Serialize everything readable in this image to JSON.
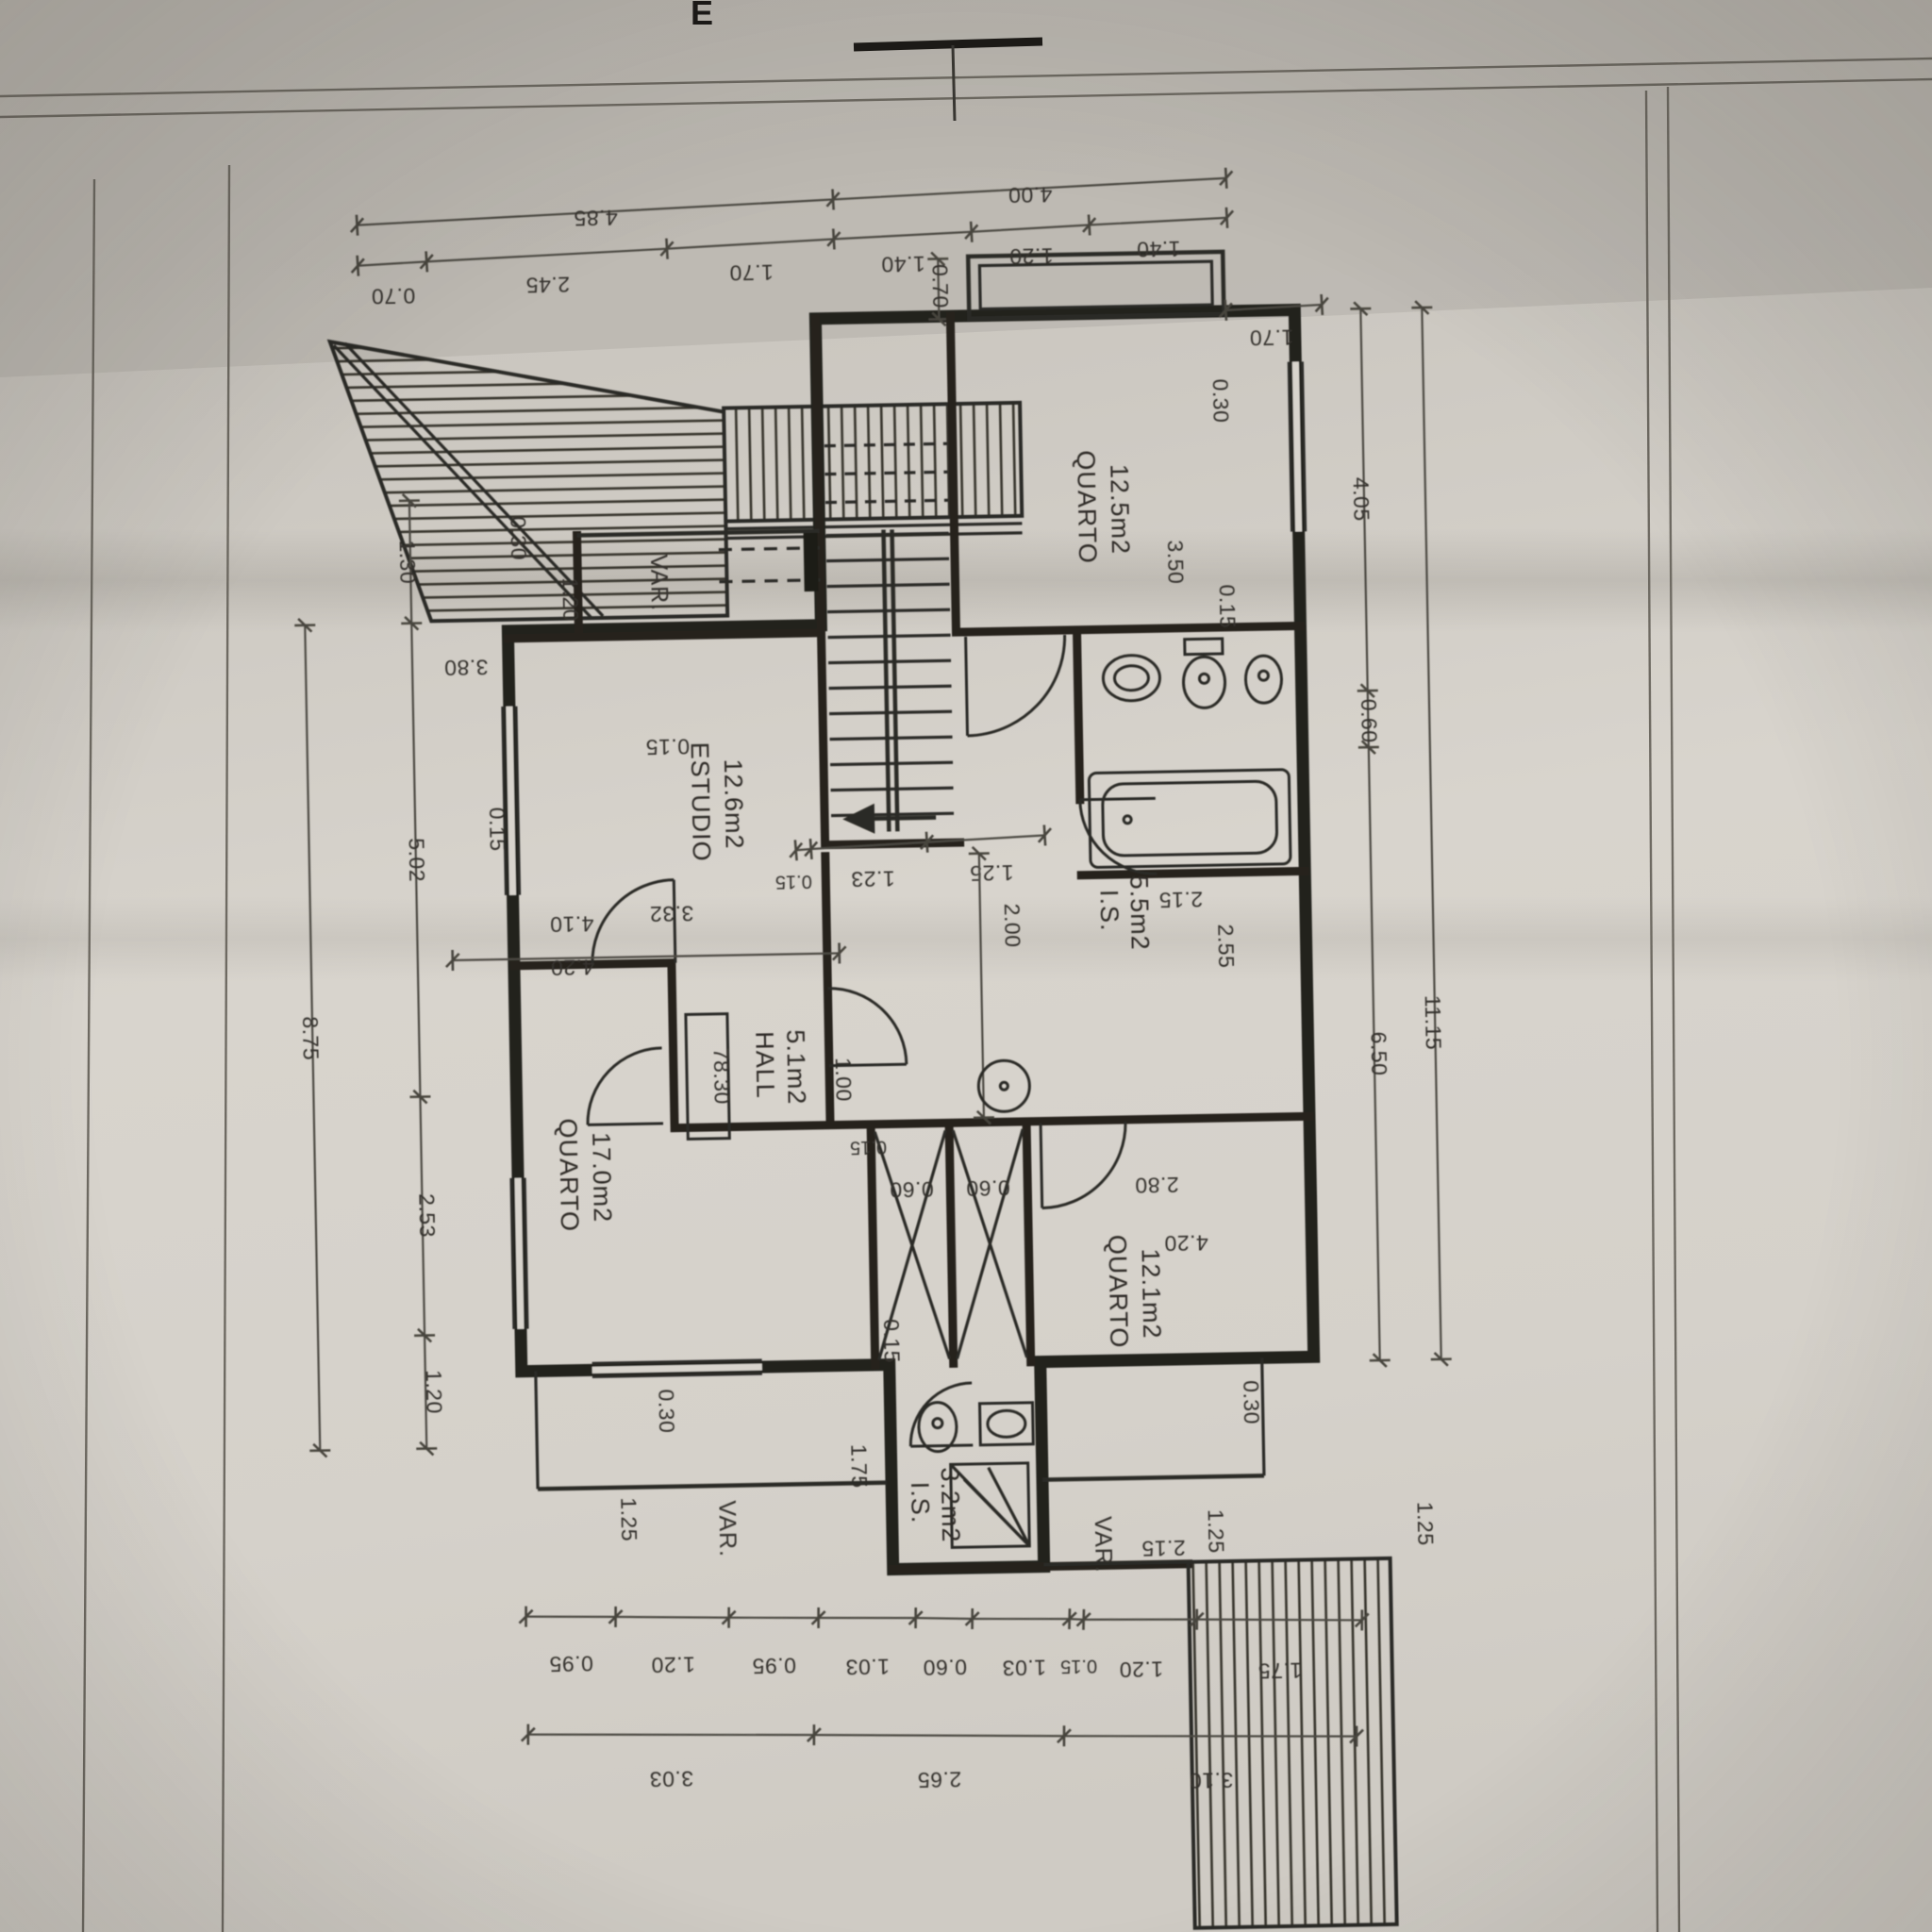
{
  "sheet": {
    "edge_letter": "E"
  },
  "rooms": {
    "q125": {
      "name": "QUARTO",
      "area": "12.5m2"
    },
    "estudio": {
      "name": "ESTUDIO",
      "area": "12.6m2"
    },
    "hall": {
      "name": "HALL",
      "area": "5.1m2"
    },
    "is55": {
      "name": "I.S.",
      "area": "5.5m2"
    },
    "q170": {
      "name": "QUARTO",
      "area": "17.0m2"
    },
    "q121": {
      "name": "QUARTO",
      "area": "12.1m2"
    },
    "is32": {
      "name": "I.S.",
      "area": "3.2m2"
    }
  },
  "labels": {
    "var": "VAR.",
    "level": "78.30"
  },
  "chains": {
    "top_outer": [
      "4.85",
      "4.00"
    ],
    "top_inner": [
      "0.70",
      "2.45",
      "1.70",
      "1.40",
      "1.20",
      "1.40"
    ],
    "top_right_extra": "1.70",
    "left_inner": [
      "1.30",
      "5.02",
      "2.53",
      "1.20"
    ],
    "left_outer": "8.75",
    "right_inner": [
      "4.05",
      "0.60",
      "6.50"
    ],
    "right_total": "11.15",
    "bottom_inner": [
      "0.95",
      "1.20",
      "0.95",
      "1.03",
      "0.60",
      "1.03",
      "0.15",
      "1.20",
      "1.75"
    ],
    "bottom_outer": [
      "3.03",
      "2.65",
      "3.10"
    ]
  },
  "dims": {
    "balcony_depth": "0.70",
    "var_top_width": "1.20",
    "var_top_wall": "0.30",
    "estudio_height": "3.80",
    "stair_wall": "0.15",
    "estudio_width": "3.32",
    "left_wall": "0.15",
    "stair_chain_a": "0.15",
    "stair_chain_b": "1.23",
    "stair_chain_c": "1.25",
    "corridor_length": "2.00",
    "hall_door": "1.00",
    "q125_side_wall": "0.30",
    "q125_depth": "3.50",
    "q125_bath_wall": "0.15",
    "bath_width": "2.15",
    "bath_length": "2.55",
    "corr_wall": "0.15",
    "ward_a": "0.60",
    "ward_b": "0.60",
    "ward_side": "0.15",
    "q170_inner": "4.10",
    "q170_outer": "4.20",
    "q121_inner": "2.80",
    "q121_outer": "4.20",
    "porch_left_wall": "0.30",
    "porch_right_wall": "0.30",
    "ext_depth": "1.75",
    "porch_left_depth": "1.25",
    "porch_right_width": "2.15",
    "porch_right_depth": "1.25",
    "terrace_step": "1.25"
  }
}
